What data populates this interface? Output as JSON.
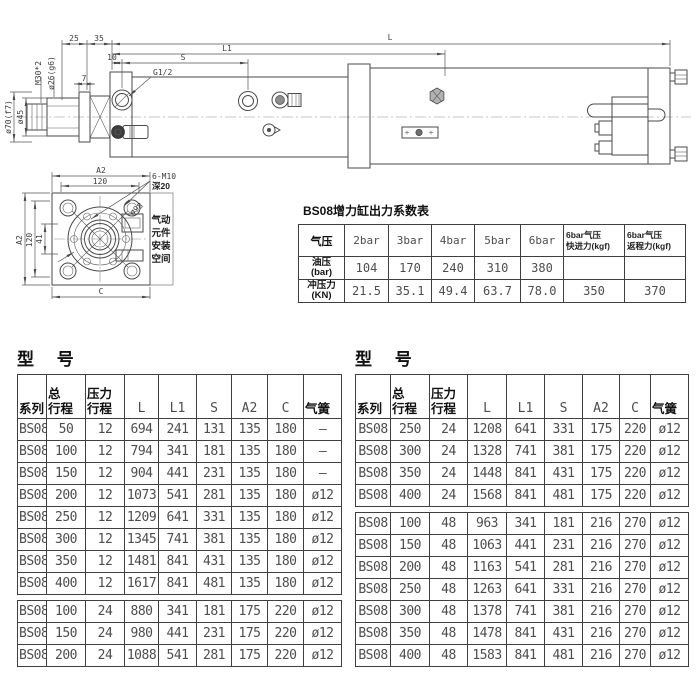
{
  "page": {
    "background": "#ffffff",
    "line_color": "#4a4a4a",
    "text_color": "#3d3d3d"
  },
  "drawing": {
    "side_view": {
      "dim_25": "25",
      "dim_35": "35",
      "dim_L": "L",
      "dim_L1": "L1",
      "dim_10": "10",
      "dim_S": "S",
      "port_label": "G1/2",
      "thread_label": "M30*2",
      "rod_tip_dia_label": "ø26(g6)",
      "dim_7": "7",
      "flange_dia_label": "ø70(f7)",
      "rod_dia_label": "ø45"
    },
    "end_view": {
      "dim_A2_top": "A2",
      "dim_120_top": "120",
      "bolt_label": "6-M10",
      "depth_label": "深20",
      "bolt_circle_label": "ø98",
      "dim_A2_left": "A2",
      "dim_120_left": "120",
      "dim_41": "41",
      "dim_C": "C",
      "space_line1": "气动",
      "space_line2": "元件",
      "space_line3": "安装",
      "space_line4": "空间"
    }
  },
  "coefficient_table": {
    "title": "BS08增力缸出力系数表",
    "headers": [
      "气压",
      "2bar",
      "3bar",
      "4bar",
      "5bar",
      "6bar",
      "6bar气压\n快进力(kgf)",
      "6bar气压\n返程力(kgf)"
    ],
    "rows": [
      [
        "油压\n(bar)",
        "104",
        "170",
        "240",
        "310",
        "380",
        "",
        ""
      ],
      [
        "冲压力\n(KN)",
        "21.5",
        "35.1",
        "49.4",
        "63.7",
        "78.0",
        "350",
        "370"
      ]
    ]
  },
  "model_tables": {
    "left_title": "型 号",
    "right_title": "型 号",
    "headers": [
      "系列",
      "总\n行程",
      "压力\n行程",
      "L",
      "L1",
      "S",
      "A2",
      "C",
      "气簧"
    ],
    "left": {
      "block1": [
        [
          "BS08",
          "50",
          "12",
          "694",
          "241",
          "131",
          "135",
          "180",
          "–"
        ],
        [
          "BS08",
          "100",
          "12",
          "794",
          "341",
          "181",
          "135",
          "180",
          "–"
        ],
        [
          "BS08",
          "150",
          "12",
          "904",
          "441",
          "231",
          "135",
          "180",
          "–"
        ],
        [
          "BS08",
          "200",
          "12",
          "1073",
          "541",
          "281",
          "135",
          "180",
          "ø12"
        ],
        [
          "BS08",
          "250",
          "12",
          "1209",
          "641",
          "331",
          "135",
          "180",
          "ø12"
        ],
        [
          "BS08",
          "300",
          "12",
          "1345",
          "741",
          "381",
          "135",
          "180",
          "ø12"
        ],
        [
          "BS08",
          "350",
          "12",
          "1481",
          "841",
          "431",
          "135",
          "180",
          "ø12"
        ],
        [
          "BS08",
          "400",
          "12",
          "1617",
          "841",
          "481",
          "135",
          "180",
          "ø12"
        ]
      ],
      "block2": [
        [
          "BS08",
          "100",
          "24",
          "880",
          "341",
          "181",
          "175",
          "220",
          "ø12"
        ],
        [
          "BS08",
          "150",
          "24",
          "980",
          "441",
          "231",
          "175",
          "220",
          "ø12"
        ],
        [
          "BS08",
          "200",
          "24",
          "1088",
          "541",
          "281",
          "175",
          "220",
          "ø12"
        ]
      ]
    },
    "right": {
      "block1": [
        [
          "BS08",
          "250",
          "24",
          "1208",
          "641",
          "331",
          "175",
          "220",
          "ø12"
        ],
        [
          "BS08",
          "300",
          "24",
          "1328",
          "741",
          "381",
          "175",
          "220",
          "ø12"
        ],
        [
          "BS08",
          "350",
          "24",
          "1448",
          "841",
          "431",
          "175",
          "220",
          "ø12"
        ],
        [
          "BS08",
          "400",
          "24",
          "1568",
          "841",
          "481",
          "175",
          "220",
          "ø12"
        ]
      ],
      "block2": [
        [
          "BS08",
          "100",
          "48",
          "963",
          "341",
          "181",
          "216",
          "270",
          "ø12"
        ],
        [
          "BS08",
          "150",
          "48",
          "1063",
          "441",
          "231",
          "216",
          "270",
          "ø12"
        ],
        [
          "BS08",
          "200",
          "48",
          "1163",
          "541",
          "281",
          "216",
          "270",
          "ø12"
        ],
        [
          "BS08",
          "250",
          "48",
          "1263",
          "641",
          "331",
          "216",
          "270",
          "ø12"
        ],
        [
          "BS08",
          "300",
          "48",
          "1378",
          "741",
          "381",
          "216",
          "270",
          "ø12"
        ],
        [
          "BS08",
          "350",
          "48",
          "1478",
          "841",
          "431",
          "216",
          "270",
          "ø12"
        ],
        [
          "BS08",
          "400",
          "48",
          "1583",
          "841",
          "481",
          "216",
          "270",
          "ø12"
        ]
      ]
    }
  }
}
